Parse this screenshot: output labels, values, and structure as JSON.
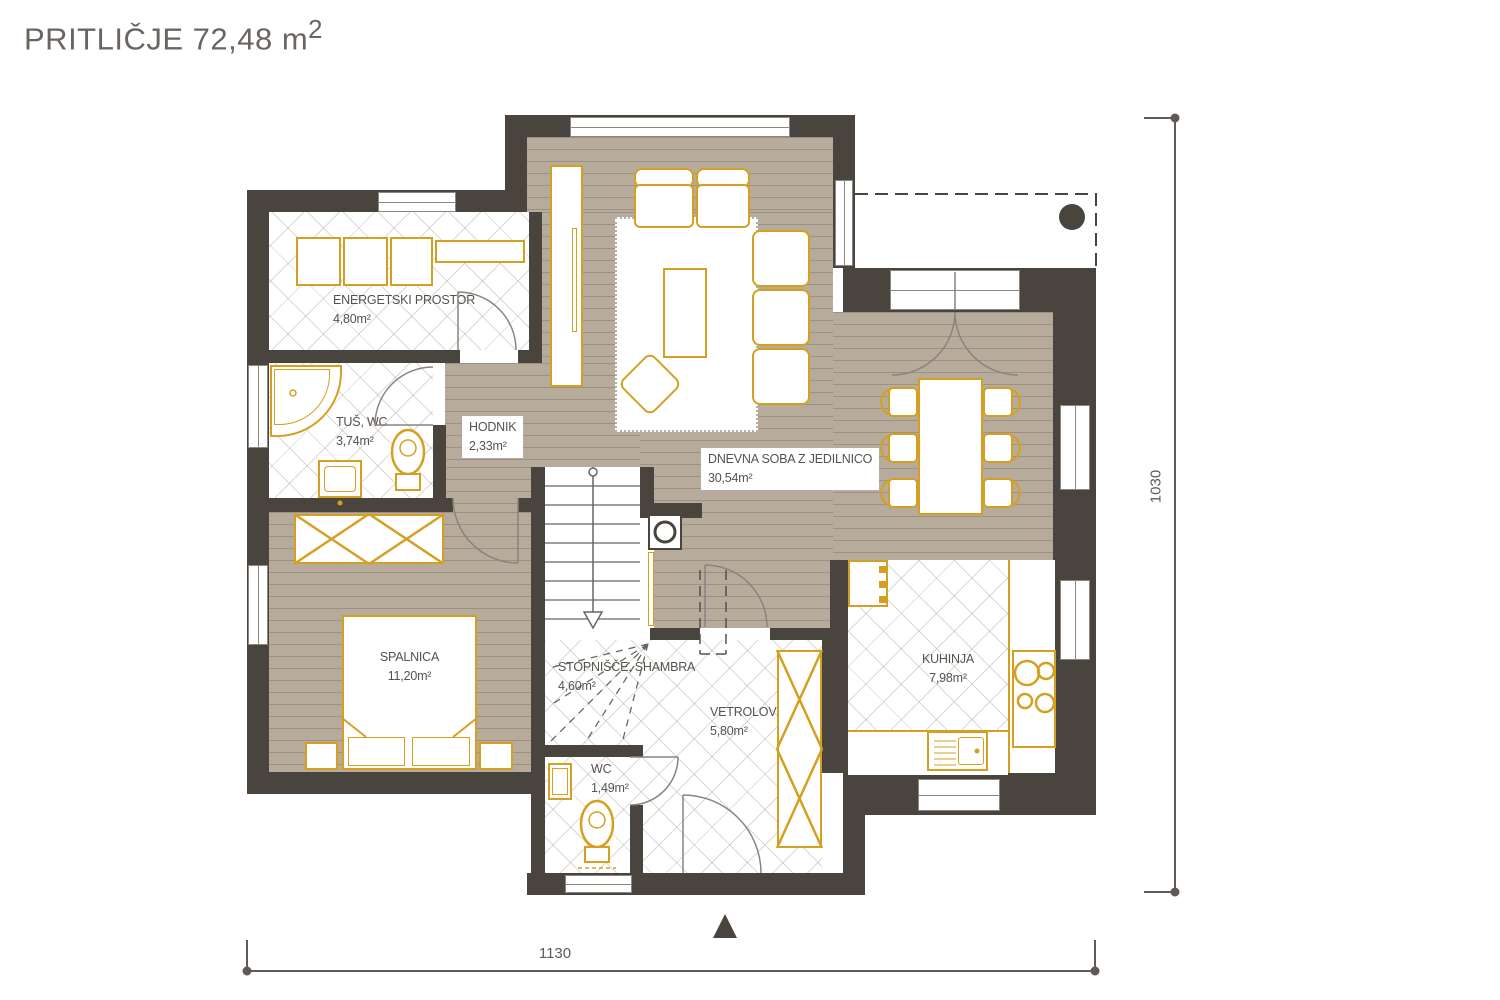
{
  "title": {
    "text": "PRITLIČJE 72,48 m",
    "sup": "2"
  },
  "rooms": {
    "energetski": {
      "name": "ENERGETSKI PROSTOR",
      "area": "4,80m²"
    },
    "tus": {
      "name": "TUŠ, WC",
      "area": "3,74m²"
    },
    "hodnik": {
      "name": "HODNIK",
      "area": "2,33m²"
    },
    "dnevna": {
      "name": "DNEVNA SOBA Z JEDILNICO",
      "area": "30,54m²"
    },
    "spalnica": {
      "name": "SPALNICA",
      "area": "11,20m²"
    },
    "stopnisce": {
      "name": "STOPNIŠČE, SHAMBRA",
      "area": "4,60m²"
    },
    "vetrolov": {
      "name": "VETROLOV",
      "area": "5,80m²"
    },
    "wc": {
      "name": "WC",
      "area": "1,49m²"
    },
    "kuhinja": {
      "name": "KUHINJA",
      "area": "7,98m²"
    }
  },
  "dimensions": {
    "width": "1130",
    "height": "1030"
  },
  "colors": {
    "wall": "#4a443f",
    "furniture_accent": "#d5a021",
    "wood_floor": "#b7ab9c"
  }
}
